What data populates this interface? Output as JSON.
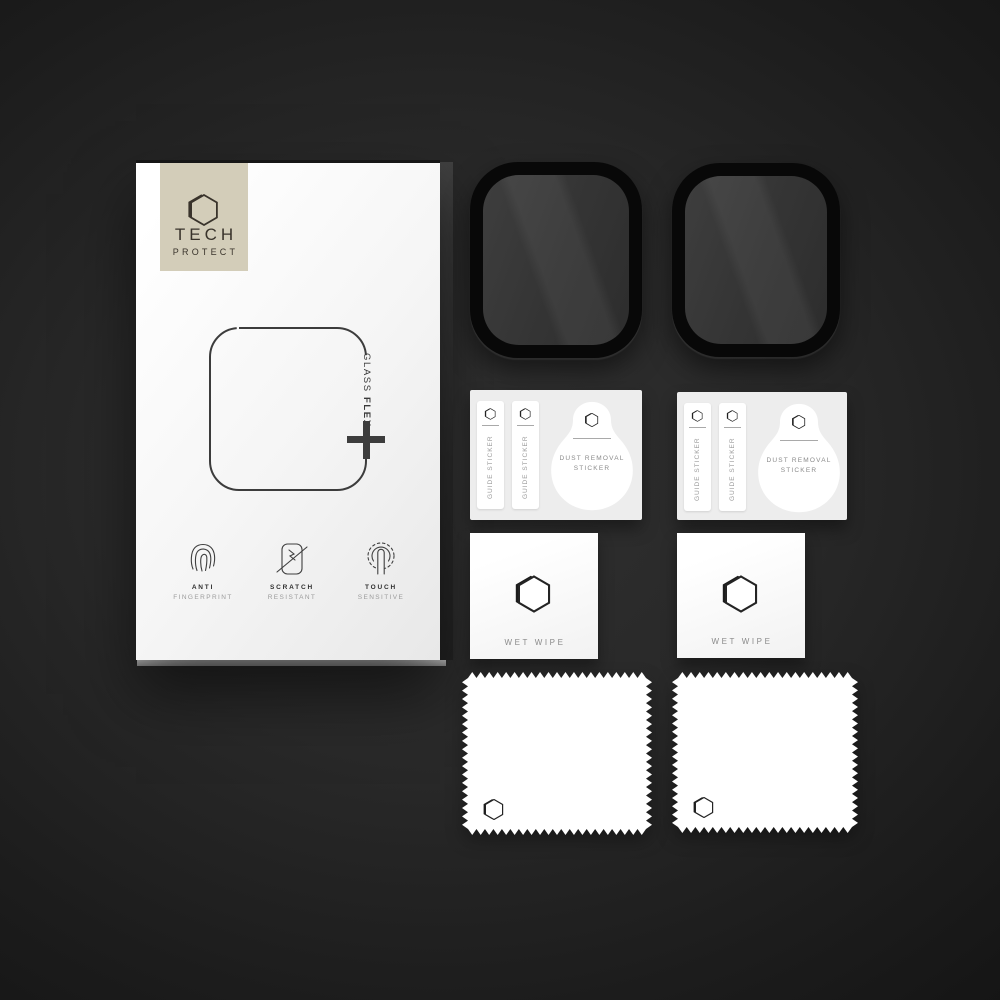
{
  "colors": {
    "background_center": "#2f2f2f",
    "background_edge": "#131313",
    "box_white": "#ffffff",
    "logo_plate_beige": "#d3cdb9",
    "brand_ink": "#39332b",
    "outline_ink": "#3c3c3c",
    "protector_black": "#080808",
    "protector_screen": "#343434",
    "card_gray": "#ededed",
    "muted_text": "#8a8a8a"
  },
  "box": {
    "brand_line1": "TECH",
    "brand_line2": "PROTECT",
    "product_word1": "GLASS",
    "product_word2": "FLEX",
    "features": [
      {
        "icon": "fingerprint-icon",
        "title": "ANTI",
        "subtitle": "FINGERPRINT"
      },
      {
        "icon": "scratch-resistant-icon",
        "title": "SCRATCH",
        "subtitle": "RESISTANT"
      },
      {
        "icon": "touch-sensitive-icon",
        "title": "TOUCH",
        "subtitle": "SENSITIVE"
      }
    ]
  },
  "accessories": {
    "screen_protectors": {
      "count": 2
    },
    "sticker_cards": [
      {
        "guide_sticker_1": "GUIDE STICKER",
        "guide_sticker_2": "GUIDE STICKER",
        "dust_line1": "DUST REMOVAL",
        "dust_line2": "STICKER"
      },
      {
        "guide_sticker_1": "GUIDE STICKER",
        "guide_sticker_2": "GUIDE STICKER",
        "dust_line1": "DUST REMOVAL",
        "dust_line2": "STICKER"
      }
    ],
    "wet_wipes": [
      {
        "label": "WET WIPE"
      },
      {
        "label": "WET WIPE"
      }
    ],
    "cloths": {
      "count": 2
    }
  }
}
